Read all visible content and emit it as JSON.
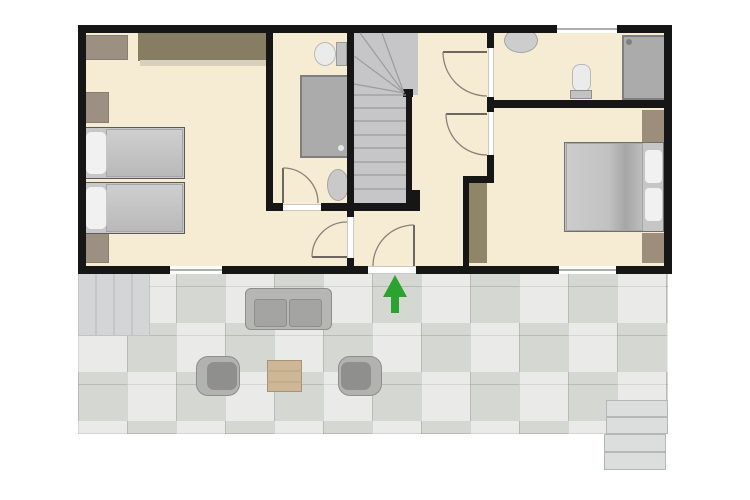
{
  "title": "apartment-floor-plan",
  "canvas": {
    "w": 750,
    "h": 500,
    "background": "#ffffff"
  },
  "palette": {
    "wall": "#161616",
    "floor_beige": "#f6ecd4",
    "stairs_gray": "#c6c6c8",
    "tile_gray": "#dedfdc",
    "step_gray": "#d4d5d7",
    "wood_dark": "#867d63",
    "wood_mid": "#9c9082",
    "wood_closet": "#9c8e7a",
    "fixture_gray": "#ababab",
    "bed_gray": "#c6c6c6",
    "pillow_white": "#f1f1f1",
    "door_arc": "#8c8276",
    "arrow_green": "#2ba32f"
  },
  "layers": {
    "floors": [
      {
        "name": "interior-floor",
        "x": 82,
        "y": 29,
        "w": 586,
        "h": 241,
        "fill": "#f6ecd4"
      },
      {
        "name": "patio-tile-area",
        "x": 78,
        "y": 274,
        "w": 590,
        "h": 160,
        "fill": "#dedfdc",
        "cls": "patio-tiles"
      },
      {
        "name": "patio-left-steps",
        "x": 78,
        "y": 273,
        "w": 72,
        "h": 63,
        "fill": "#d4d5d7",
        "border": "#c2c4c1",
        "bw": 1
      },
      {
        "name": "patio-right-step-1",
        "x": 606,
        "y": 400,
        "w": 62,
        "h": 17,
        "fill": "#dcdedd",
        "border": "#b5b7b4",
        "bw": 1
      },
      {
        "name": "patio-right-step-2",
        "x": 606,
        "y": 417,
        "w": 62,
        "h": 17,
        "fill": "#dcdedd",
        "border": "#b5b7b4",
        "bw": 1
      },
      {
        "name": "patio-right-step-3",
        "x": 604,
        "y": 434,
        "w": 62,
        "h": 18,
        "fill": "#dcdedd",
        "border": "#b5b7b4",
        "bw": 1
      },
      {
        "name": "patio-right-step-4",
        "x": 604,
        "y": 452,
        "w": 62,
        "h": 18,
        "fill": "#dcdedd",
        "border": "#b5b7b4",
        "bw": 1
      },
      {
        "name": "stairs-winder-area",
        "x": 354,
        "y": 33,
        "w": 64,
        "h": 62,
        "fill": "#c6c6c8"
      },
      {
        "name": "stairs-run-area",
        "x": 354,
        "y": 95,
        "w": 53,
        "h": 108,
        "fill": "#c6c6c8"
      }
    ],
    "furniture": [
      {
        "name": "left-bedroom-wardrobe",
        "x": 138,
        "y": 33,
        "w": 129,
        "h": 28,
        "fill": "#867d63"
      },
      {
        "name": "left-bedroom-wardrobe-front",
        "x": 140,
        "y": 60,
        "w": 127,
        "h": 6,
        "fill": "#d6d0bd"
      },
      {
        "name": "left-bedroom-cabinet",
        "x": 84,
        "y": 35,
        "w": 44,
        "h": 25,
        "fill": "#9c9082",
        "border": "#8a7e70",
        "bw": 1
      },
      {
        "name": "left-bedroom-nightstand-top",
        "x": 84,
        "y": 92,
        "w": 25,
        "h": 31,
        "fill": "#9c9082",
        "border": "#8a7e70",
        "bw": 1
      },
      {
        "name": "left-bedroom-nightstand-bottom",
        "x": 84,
        "y": 233,
        "w": 25,
        "h": 30,
        "fill": "#9c9082",
        "border": "#8a7e70",
        "bw": 1
      },
      {
        "name": "single-bed-1-frame",
        "x": 82,
        "y": 127,
        "w": 103,
        "h": 52,
        "fill": "#c8c8c8",
        "border": "#5a5a5a",
        "bw": 1
      },
      {
        "name": "single-bed-1-duvet",
        "x": 106,
        "y": 129,
        "w": 77,
        "h": 48,
        "fill": "#c3c3c3",
        "grad": "linear-gradient(180deg,#cfcfcf,#b9b9b9)",
        "border": "#a5a5a5",
        "bw": 1
      },
      {
        "name": "single-bed-1-pillow",
        "x": 85,
        "y": 131,
        "w": 22,
        "h": 44,
        "fill": "#f1f1f1",
        "border": "#c6c6c6",
        "bw": 1,
        "rx": 6
      },
      {
        "name": "single-bed-2-frame",
        "x": 82,
        "y": 182,
        "w": 103,
        "h": 52,
        "fill": "#c8c8c8",
        "border": "#5a5a5a",
        "bw": 1
      },
      {
        "name": "single-bed-2-duvet",
        "x": 106,
        "y": 184,
        "w": 77,
        "h": 48,
        "fill": "#c3c3c3",
        "grad": "linear-gradient(180deg,#cfcfcf,#b9b9b9)",
        "border": "#a5a5a5",
        "bw": 1
      },
      {
        "name": "single-bed-2-pillow",
        "x": 85,
        "y": 186,
        "w": 22,
        "h": 44,
        "fill": "#f1f1f1",
        "border": "#c6c6c6",
        "bw": 1,
        "rx": 6
      },
      {
        "name": "bathroom1-toilet-tank",
        "x": 336,
        "y": 42,
        "w": 11,
        "h": 24,
        "fill": "#c2c2c2",
        "border": "#999999",
        "bw": 1
      },
      {
        "name": "bathroom1-toilet-bowl",
        "x": 314,
        "y": 42,
        "w": 22,
        "h": 24,
        "fill": "#ebebeb",
        "border": "#b9b9b9",
        "bw": 1,
        "shape": "ellipse"
      },
      {
        "name": "bathroom1-shower-tray",
        "x": 300,
        "y": 75,
        "w": 50,
        "h": 83,
        "fill": "#ababab",
        "border": "#7f7f7f",
        "bw": 2
      },
      {
        "name": "bathroom1-shower-drain",
        "x": 338,
        "y": 145,
        "w": 6,
        "h": 6,
        "fill": "#e6e6e6",
        "shape": "ellipse"
      },
      {
        "name": "bathroom1-sink",
        "x": 327,
        "y": 169,
        "w": 22,
        "h": 32,
        "fill": "#c9c9c9",
        "border": "#a5a5a5",
        "bw": 1,
        "shape": "ellipse"
      },
      {
        "name": "bathroom2-sink",
        "x": 504,
        "y": 28,
        "w": 34,
        "h": 25,
        "fill": "#cdcdcd",
        "border": "#a5a5a5",
        "bw": 1,
        "shape": "ellipse"
      },
      {
        "name": "bathroom2-toilet-bowl",
        "x": 572,
        "y": 64,
        "w": 19,
        "h": 28,
        "fill": "#ebebeb",
        "border": "#b9b9b9",
        "bw": 1,
        "rx": 8
      },
      {
        "name": "bathroom2-toilet-tank",
        "x": 570,
        "y": 90,
        "w": 22,
        "h": 9,
        "fill": "#c2c2c2",
        "border": "#8f8f8f",
        "bw": 1
      },
      {
        "name": "bathroom2-shower-tray",
        "x": 622,
        "y": 35,
        "w": 44,
        "h": 65,
        "fill": "#ababab",
        "border": "#7f7f7f",
        "bw": 2
      },
      {
        "name": "bathroom2-shower-head",
        "x": 626,
        "y": 39,
        "w": 6,
        "h": 6,
        "fill": "#7f7f7f",
        "shape": "ellipse"
      },
      {
        "name": "hall-wardrobe",
        "x": 468,
        "y": 183,
        "w": 19,
        "h": 80,
        "fill": "#8f8669"
      },
      {
        "name": "right-bedroom-closet-top",
        "x": 642,
        "y": 110,
        "w": 22,
        "h": 32,
        "fill": "#9c8e7a"
      },
      {
        "name": "right-bedroom-closet-bottom",
        "x": 642,
        "y": 233,
        "w": 22,
        "h": 30,
        "fill": "#9c8e7a"
      },
      {
        "name": "double-bed-frame",
        "x": 564,
        "y": 142,
        "w": 100,
        "h": 90,
        "fill": "#c6c6c6",
        "border": "#6f6f6f",
        "bw": 1
      },
      {
        "name": "double-bed-duvet",
        "x": 566,
        "y": 143,
        "w": 77,
        "h": 88,
        "fill": "#c5c5c5",
        "grad": "linear-gradient(90deg,#cccccc 0%,#c2c2c2 55%,#a6a6a6 78%,#bdbdbd 100%)",
        "border": "#a5a5a5",
        "bw": 1
      },
      {
        "name": "double-bed-pillow-1",
        "x": 644,
        "y": 149,
        "w": 19,
        "h": 35,
        "fill": "#f1f1f1",
        "border": "#c6c6c6",
        "bw": 1,
        "rx": 5
      },
      {
        "name": "double-bed-pillow-2",
        "x": 644,
        "y": 187,
        "w": 19,
        "h": 35,
        "fill": "#f1f1f1",
        "border": "#c6c6c6",
        "bw": 1,
        "rx": 5
      },
      {
        "name": "patio-sofa",
        "x": 245,
        "y": 288,
        "w": 87,
        "h": 42,
        "fill": "#b6b6b4",
        "border": "#8e8e8c",
        "bw": 1,
        "rx": 6
      },
      {
        "name": "patio-sofa-seat-left",
        "x": 254,
        "y": 299,
        "w": 33,
        "h": 28,
        "fill": "#a4a4a2",
        "border": "#8e8e8c",
        "bw": 1,
        "rx": 3
      },
      {
        "name": "patio-sofa-seat-right",
        "x": 289,
        "y": 299,
        "w": 33,
        "h": 28,
        "fill": "#a4a4a2",
        "border": "#8e8e8c",
        "bw": 1,
        "rx": 3
      },
      {
        "name": "patio-armchair-left",
        "x": 196,
        "y": 356,
        "w": 44,
        "h": 40,
        "fill": "#b2b2b0",
        "border": "#8e8e8c",
        "bw": 1,
        "rx": 12
      },
      {
        "name": "patio-armchair-left-seat",
        "x": 207,
        "y": 362,
        "w": 30,
        "h": 28,
        "fill": "#8f8f8d",
        "rx": 7
      },
      {
        "name": "patio-armchair-right",
        "x": 338,
        "y": 356,
        "w": 44,
        "h": 40,
        "fill": "#b2b2b0",
        "border": "#8e8e8c",
        "bw": 1,
        "rx": 12
      },
      {
        "name": "patio-armchair-right-seat",
        "x": 341,
        "y": 362,
        "w": 30,
        "h": 28,
        "fill": "#8f8f8d",
        "rx": 7
      },
      {
        "name": "patio-coffee-table",
        "x": 267,
        "y": 360,
        "w": 35,
        "h": 32,
        "fill": "#cdb795",
        "border": "#a8937a",
        "bw": 1
      }
    ],
    "walls": [
      {
        "name": "outer-wall-top-left",
        "x": 78,
        "y": 25,
        "w": 479,
        "h": 8
      },
      {
        "name": "outer-wall-top-right",
        "x": 617,
        "y": 25,
        "w": 55,
        "h": 8
      },
      {
        "name": "outer-wall-left",
        "x": 78,
        "y": 25,
        "w": 8,
        "h": 249
      },
      {
        "name": "outer-wall-right",
        "x": 664,
        "y": 25,
        "w": 8,
        "h": 249
      },
      {
        "name": "outer-wall-bottom-a",
        "x": 78,
        "y": 266,
        "w": 92,
        "h": 8
      },
      {
        "name": "outer-wall-bottom-b",
        "x": 222,
        "y": 266,
        "w": 146,
        "h": 8
      },
      {
        "name": "outer-wall-bottom-c",
        "x": 416,
        "y": 266,
        "w": 143,
        "h": 8
      },
      {
        "name": "outer-wall-bottom-d",
        "x": 616,
        "y": 266,
        "w": 56,
        "h": 8
      },
      {
        "name": "wall-bedroom1-bath",
        "x": 266,
        "y": 33,
        "w": 7,
        "h": 178
      },
      {
        "name": "wall-stairs-left",
        "x": 347,
        "y": 33,
        "w": 7,
        "h": 170
      },
      {
        "name": "wall-bath-bottom-a",
        "x": 266,
        "y": 203,
        "w": 17,
        "h": 8
      },
      {
        "name": "wall-bath-bottom-b",
        "x": 321,
        "y": 203,
        "w": 99,
        "h": 8
      },
      {
        "name": "wall-stairs-stub",
        "x": 412,
        "y": 190,
        "w": 8,
        "h": 13
      },
      {
        "name": "wall-vestibule-top",
        "x": 347,
        "y": 211,
        "w": 7,
        "h": 6
      },
      {
        "name": "wall-vestibule-bottom",
        "x": 347,
        "y": 258,
        "w": 7,
        "h": 8
      },
      {
        "name": "wall-hall-right-a",
        "x": 487,
        "y": 33,
        "w": 7,
        "h": 15
      },
      {
        "name": "wall-hall-right-b",
        "x": 487,
        "y": 97,
        "w": 7,
        "h": 15
      },
      {
        "name": "wall-hall-right-c",
        "x": 487,
        "y": 155,
        "w": 7,
        "h": 28
      },
      {
        "name": "wall-hall-stub",
        "x": 463,
        "y": 176,
        "w": 31,
        "h": 7
      },
      {
        "name": "wall-closet-side",
        "x": 463,
        "y": 183,
        "w": 6,
        "h": 83
      },
      {
        "name": "wall-bath2-bedroom2",
        "x": 487,
        "y": 100,
        "w": 185,
        "h": 8
      },
      {
        "name": "stairs-handrail",
        "x": 406,
        "y": 91,
        "w": 6,
        "h": 112
      },
      {
        "name": "stairs-newel",
        "x": 403,
        "y": 89,
        "w": 10,
        "h": 8
      }
    ],
    "openings": [
      {
        "name": "window-bedroom1",
        "x": 170,
        "y": 266,
        "w": 52,
        "h": 8,
        "cls": "win-h"
      },
      {
        "name": "window-bedroom2",
        "x": 559,
        "y": 266,
        "w": 57,
        "h": 8,
        "cls": "win-h"
      },
      {
        "name": "window-bathroom2",
        "x": 557,
        "y": 25,
        "w": 60,
        "h": 8,
        "cls": "win-h"
      },
      {
        "name": "threshold-bathroom1-door",
        "x": 283,
        "y": 204,
        "w": 38,
        "h": 7,
        "cls": "thr-h"
      },
      {
        "name": "threshold-vestibule-door",
        "x": 347,
        "y": 217,
        "w": 7,
        "h": 41,
        "cls": "thr-v"
      },
      {
        "name": "threshold-hall-door-upper",
        "x": 488,
        "y": 48,
        "w": 6,
        "h": 49,
        "cls": "thr-v"
      },
      {
        "name": "threshold-hall-door-lower",
        "x": 488,
        "y": 112,
        "w": 6,
        "h": 43,
        "cls": "thr-v"
      },
      {
        "name": "threshold-entrance",
        "x": 368,
        "y": 266,
        "w": 48,
        "h": 8,
        "cls": "thr-h"
      }
    ],
    "svg_paths": [
      {
        "name": "door-bathroom1-leaf",
        "d": "M283,203 L283,168",
        "stroke": "#6d675d",
        "width": 2
      },
      {
        "name": "door-bathroom1-arc",
        "d": "M283,168 A35,35 0 0 1 318,203",
        "stroke": "#8c8276",
        "width": 1.3
      },
      {
        "name": "door-vestibule-leaf",
        "d": "M347,257 L312,257",
        "stroke": "#6d675d",
        "width": 2
      },
      {
        "name": "door-vestibule-arc",
        "d": "M312,257 A35,35 0 0 1 347,222",
        "stroke": "#8c8276",
        "width": 1.3
      },
      {
        "name": "door-entrance-leaf",
        "d": "M414,266 L414,225",
        "stroke": "#6d675d",
        "width": 2
      },
      {
        "name": "door-entrance-arc",
        "d": "M414,225 A41,41 0 0 0 373,266",
        "stroke": "#8c8276",
        "width": 1.3
      },
      {
        "name": "door-hall-upper-leaf",
        "d": "M487,52 L443,52",
        "stroke": "#6d675d",
        "width": 2
      },
      {
        "name": "door-hall-upper-arc",
        "d": "M443,52 A44,44 0 0 0 487,96",
        "stroke": "#8c8276",
        "width": 1.3
      },
      {
        "name": "door-hall-lower-leaf",
        "d": "M487,114 L446,114",
        "stroke": "#6d675d",
        "width": 2
      },
      {
        "name": "door-hall-lower-arc",
        "d": "M446,114 A41,41 0 0 0 487,155",
        "stroke": "#8c8276",
        "width": 1.3
      },
      {
        "name": "stair-tread-1",
        "d": "M354,108 L406,108",
        "stroke": "#9c9c9e",
        "width": 1.2
      },
      {
        "name": "stair-tread-2",
        "d": "M354,121 L406,121",
        "stroke": "#9c9c9e",
        "width": 1.2
      },
      {
        "name": "stair-tread-3",
        "d": "M354,135 L406,135",
        "stroke": "#9c9c9e",
        "width": 1.2
      },
      {
        "name": "stair-tread-4",
        "d": "M354,148 L406,148",
        "stroke": "#9c9c9e",
        "width": 1.2
      },
      {
        "name": "stair-tread-5",
        "d": "M354,162 L406,162",
        "stroke": "#9c9c9e",
        "width": 1.2
      },
      {
        "name": "stair-tread-6",
        "d": "M354,175 L406,175",
        "stroke": "#9c9c9e",
        "width": 1.2
      },
      {
        "name": "stair-tread-7",
        "d": "M354,189 L406,189",
        "stroke": "#9c9c9e",
        "width": 1.2
      },
      {
        "name": "stair-winder-base",
        "d": "M354,95 L406,95",
        "stroke": "#9c9c9e",
        "width": 1.2
      },
      {
        "name": "stair-winder-fan-1",
        "d": "M404,93 L354,84",
        "stroke": "#9c9c9e",
        "width": 1.2
      },
      {
        "name": "stair-winder-fan-2",
        "d": "M404,93 L354,56",
        "stroke": "#9c9c9e",
        "width": 1.2
      },
      {
        "name": "stair-winder-fan-3",
        "d": "M404,93 L360,33",
        "stroke": "#9c9c9e",
        "width": 1.2
      },
      {
        "name": "stair-winder-fan-4",
        "d": "M404,93 L382,33",
        "stroke": "#9c9c9e",
        "width": 1.2
      },
      {
        "name": "patio-left-step-line-1",
        "d": "M96,274 L96,335",
        "stroke": "#bfc1c3",
        "width": 1.5
      },
      {
        "name": "patio-left-step-line-2",
        "d": "M114,274 L114,335",
        "stroke": "#bfc1c3",
        "width": 1.5
      },
      {
        "name": "patio-left-step-line-3",
        "d": "M132,274 L132,335",
        "stroke": "#bfc1c3",
        "width": 1.5
      },
      {
        "name": "table-seam",
        "d": "M267,371 L302,371 M267,382 L302,382",
        "stroke": "#b9a584",
        "width": 1
      }
    ],
    "svg_polygons": [
      {
        "name": "entrance-arrow",
        "points": "395,275 407,297 399,297 399,313 391,313 391,297 383,297",
        "fill": "#2ba32f"
      }
    ]
  }
}
